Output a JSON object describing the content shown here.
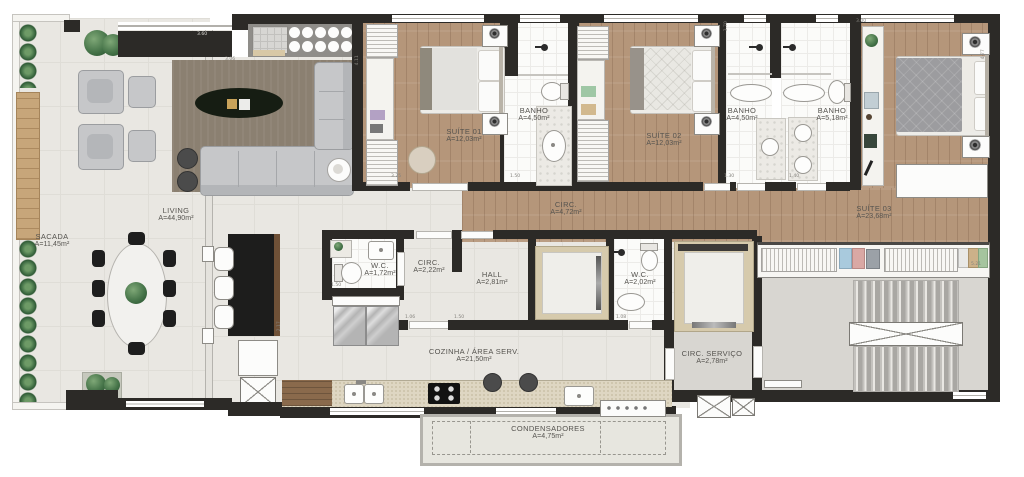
{
  "plan_title": "apartment-floor-plan",
  "rooms": [
    {
      "id": "sacada",
      "name": "SACADA",
      "area": "A=11,45m²"
    },
    {
      "id": "living",
      "name": "LIVING",
      "area": "A=44,90m²"
    },
    {
      "id": "suite01",
      "name": "SUÍTE 01",
      "area": "A=12,03m²"
    },
    {
      "id": "banho1",
      "name": "BANHO",
      "area": "A=4,50m²"
    },
    {
      "id": "suite02",
      "name": "SUÍTE 02",
      "area": "A=12,03m²"
    },
    {
      "id": "banho2",
      "name": "BANHO",
      "area": "A=4,50m²"
    },
    {
      "id": "banho3",
      "name": "BANHO",
      "area": "A=5,18m²"
    },
    {
      "id": "suite03",
      "name": "SUÍTE 03",
      "area": "A=23,68m²"
    },
    {
      "id": "circ",
      "name": "CIRC.",
      "area": "A=4,72m²"
    },
    {
      "id": "wc1",
      "name": "W.C.",
      "area": "A=1,72m²"
    },
    {
      "id": "circ2",
      "name": "CIRC.",
      "area": "A=2,22m²"
    },
    {
      "id": "hall",
      "name": "HALL",
      "area": "A=2,81m²"
    },
    {
      "id": "wc2",
      "name": "W.C.",
      "area": "A=2,02m²"
    },
    {
      "id": "cozinha",
      "name": "COZINHA / ÁREA SERV.",
      "area": "A=21,50m²"
    },
    {
      "id": "circ_servico",
      "name": "CIRC. SERVIÇO",
      "area": "A=2,78m²"
    },
    {
      "id": "condensadores",
      "name": "CONDENSADORES",
      "area": "A=4,75m²"
    }
  ],
  "dimensions": [
    {
      "text": "3.60"
    },
    {
      "text": "3.06"
    },
    {
      "text": "3.25"
    },
    {
      "text": "1.50"
    },
    {
      "text": "1.30"
    },
    {
      "text": "1.40"
    },
    {
      "text": "1.50"
    },
    {
      "text": "1.06"
    },
    {
      "text": "1.50"
    },
    {
      "text": "1.08"
    },
    {
      "text": "3.00"
    },
    {
      "text": "5.21"
    },
    {
      "text": "2.17"
    },
    {
      "text": "4.11"
    },
    {
      "text": "3.70"
    },
    {
      "text": "4.77"
    }
  ],
  "colors": {
    "wall": "#2c2a27",
    "wood_floor": "#b5967a",
    "tile_floor": "#e9e7e2",
    "bath_floor": "#fbfbf9",
    "stairs_floor": "#d8d6d1",
    "elevator_frame": "#d6caac",
    "kitchen_counter": "#ded6c2",
    "rug": "#8b8071",
    "plant_green": "#47754a",
    "sofa_gray": "#c6c7c9",
    "dark_furniture": "#1e1e1e"
  }
}
